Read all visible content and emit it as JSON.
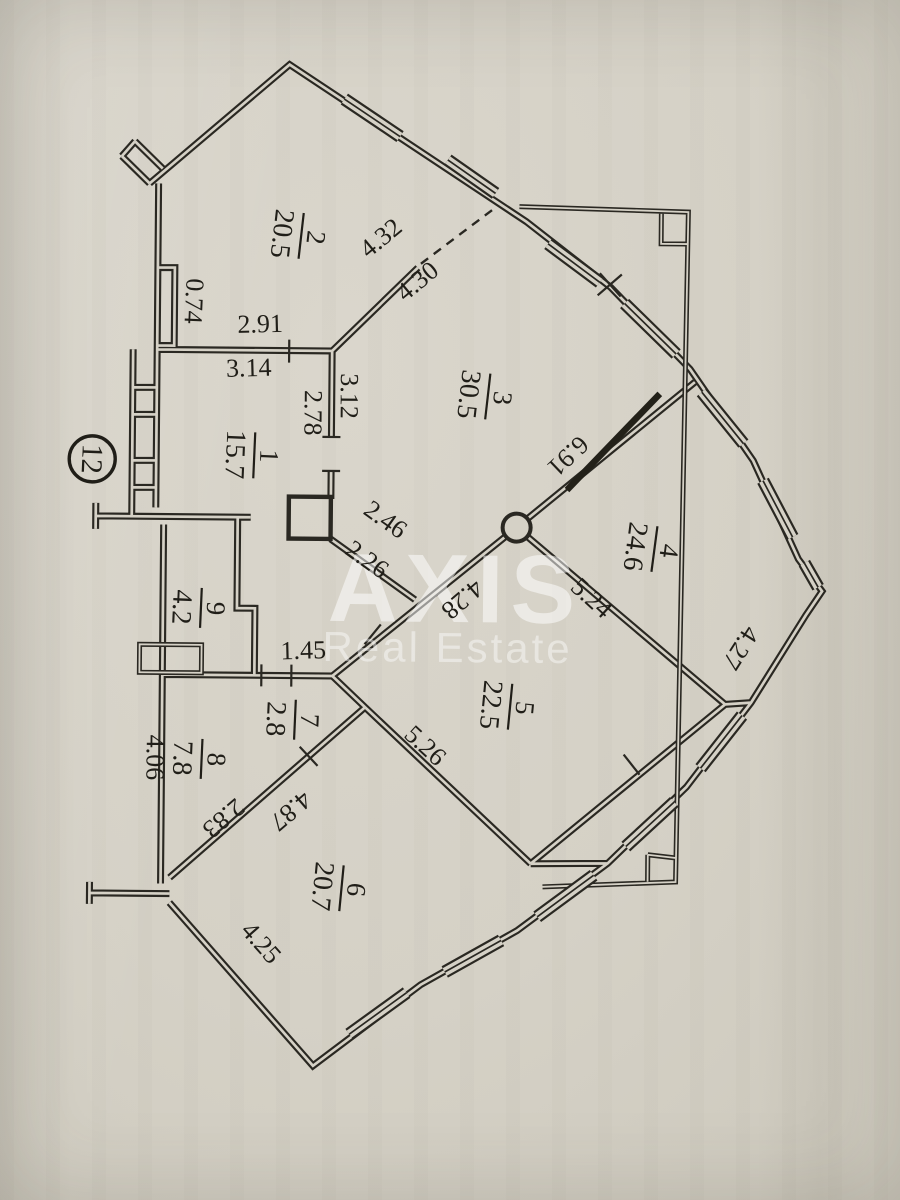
{
  "badge": {
    "apartment_number": "12"
  },
  "watermark": {
    "line1": "AXIS",
    "line2": "Real Estate"
  },
  "rooms": [
    {
      "number": "1",
      "area": "15.7"
    },
    {
      "number": "2",
      "area": "20.5"
    },
    {
      "number": "3",
      "area": "30.5"
    },
    {
      "number": "4",
      "area": "24.6"
    },
    {
      "number": "5",
      "area": "22.5"
    },
    {
      "number": "6",
      "area": "20.7"
    },
    {
      "number": "7",
      "area": "2.8"
    },
    {
      "number": "8",
      "area": "7.8"
    },
    {
      "number": "9",
      "area": "4.2"
    }
  ],
  "dims": [
    {
      "v": "0.74"
    },
    {
      "v": "2.91"
    },
    {
      "v": "3.14"
    },
    {
      "v": "2.78"
    },
    {
      "v": "3.12"
    },
    {
      "v": "4.32"
    },
    {
      "v": "4.30"
    },
    {
      "v": "6.91"
    },
    {
      "v": "2.46"
    },
    {
      "v": "2.26"
    },
    {
      "v": "4.28"
    },
    {
      "v": "5.24"
    },
    {
      "v": "4.27"
    },
    {
      "v": "1.45"
    },
    {
      "v": "4.06"
    },
    {
      "v": "5.26"
    },
    {
      "v": "2.83"
    },
    {
      "v": "4.87"
    },
    {
      "v": "4.25"
    }
  ]
}
